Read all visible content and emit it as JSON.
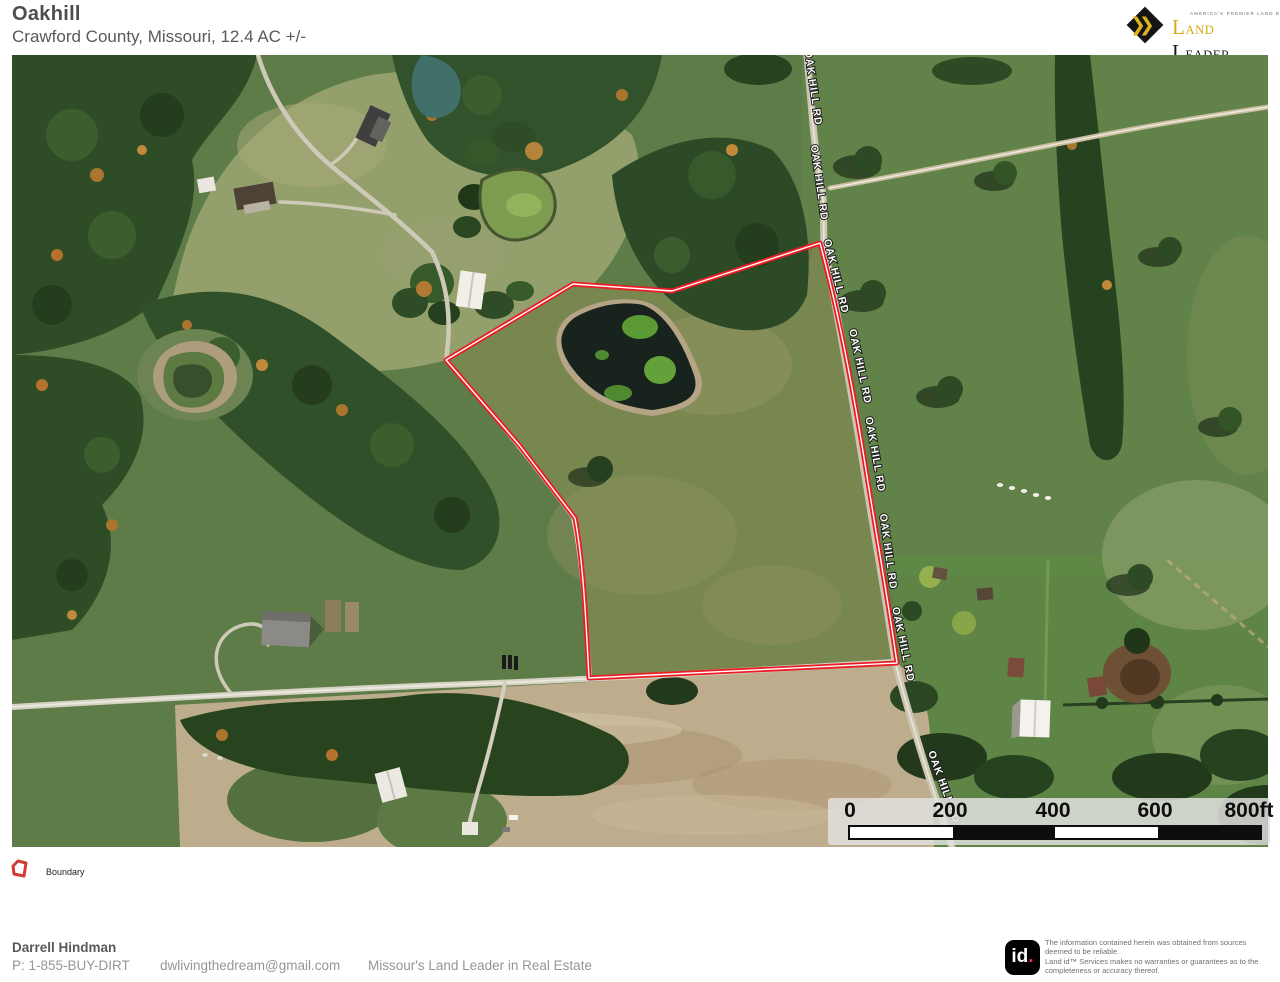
{
  "header": {
    "title": "Oakhill",
    "subtitle": "Crawford County, Missouri, 12.4 AC +/-"
  },
  "brand": {
    "tagline": "AMERICA'S PREMIER LAND BROKERS",
    "chevrons": "❯❯",
    "name_part1": "Land",
    "name_part2": "Leader"
  },
  "map": {
    "road_label": "OAK HILL RD"
  },
  "scale_bar": {
    "ticks": [
      "0",
      "200",
      "400",
      "600"
    ],
    "end_label": "800ft"
  },
  "legend": {
    "boundary_label": "Boundary"
  },
  "footer": {
    "agent_name": "Darrell Hindman",
    "phone": "P: 1-855-BUY-DIRT",
    "email": "dwlivingthedream@gmail.com",
    "slogan": "Missour's Land Leader in Real Estate"
  },
  "attribution": {
    "logo_text": "id",
    "logo_dot": ".",
    "disclaimer_line1": "The information contained herein was obtained from sources deemed to be reliable.",
    "disclaimer_line2": "Land id™ Services makes no warranties or guarantees as to the completeness or accuracy thereof."
  },
  "colors": {
    "boundary_red": "#ec1c24",
    "brand_gold": "#d7a918",
    "pasture_green": "#5e7c48",
    "forest_green": "#2e4c26",
    "plowed_tan": "#bead8d"
  }
}
